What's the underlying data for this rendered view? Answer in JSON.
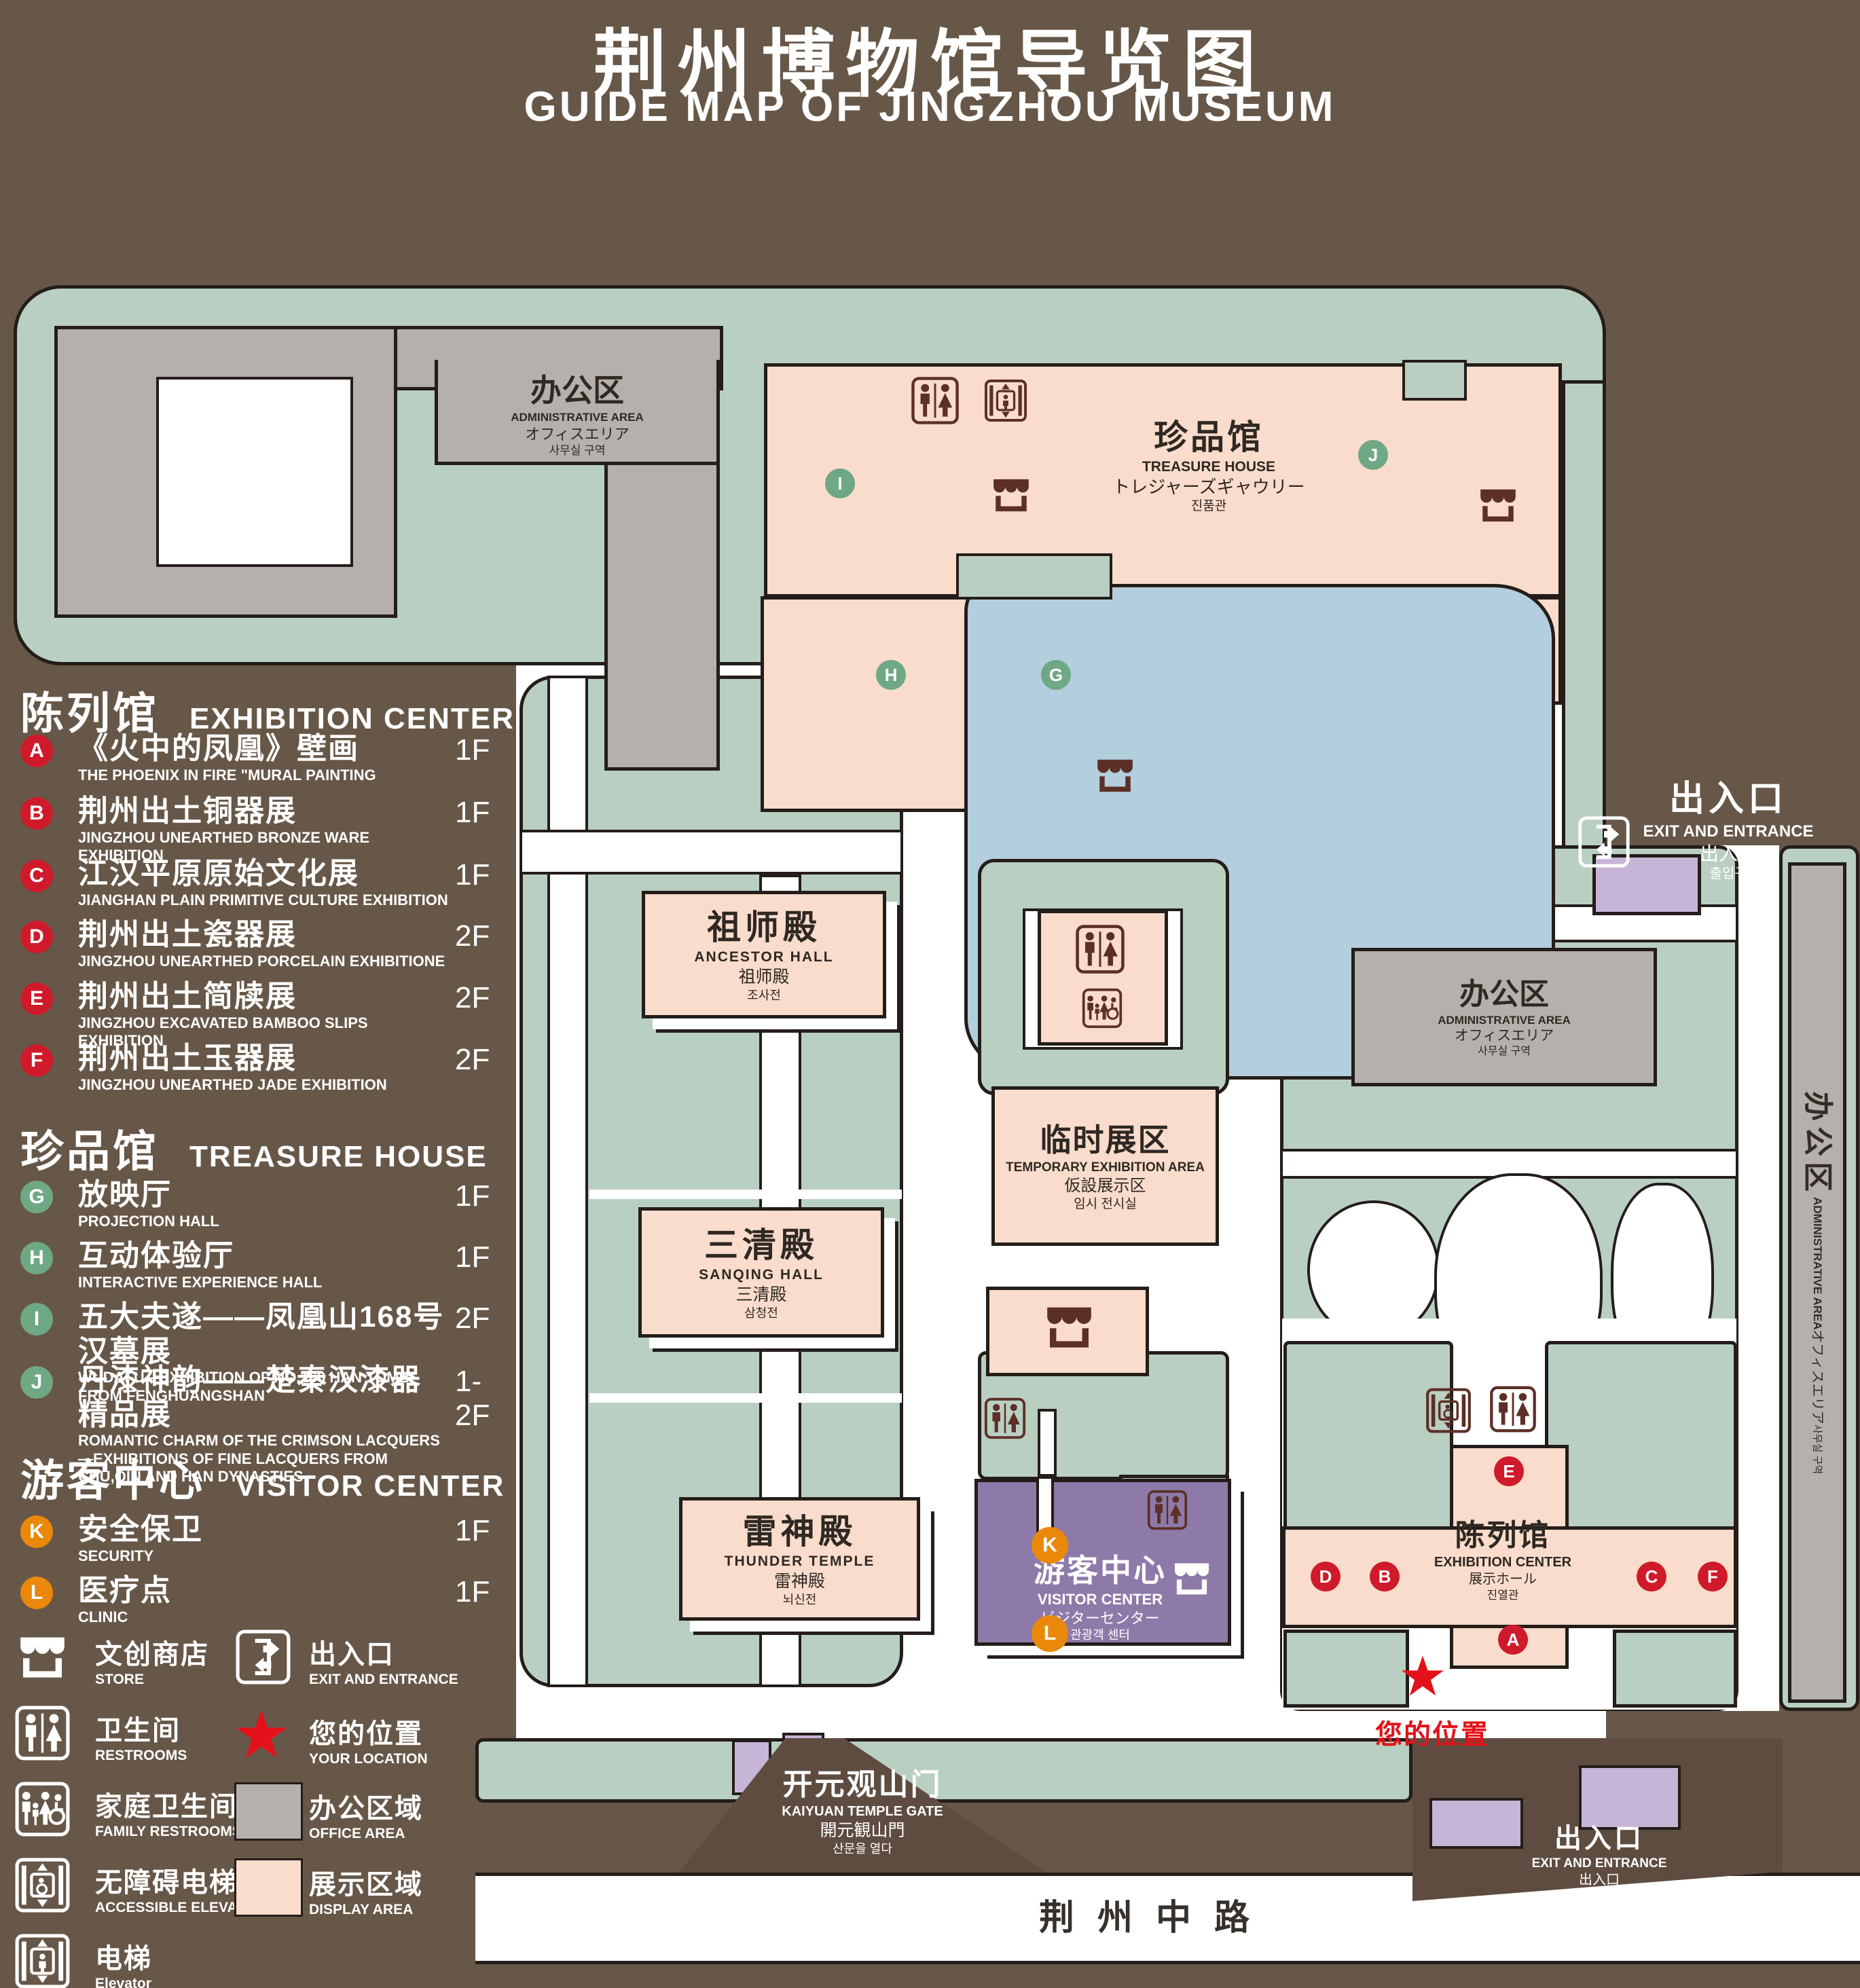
{
  "title": {
    "zh": "荆州博物馆导览图",
    "en": "GUIDE MAP OF JINGZHOU MUSEUM"
  },
  "legend": {
    "sections": [
      {
        "zh": "陈列馆",
        "en": "EXHIBITION CENTER",
        "items": [
          {
            "key": "A",
            "zh": "《火中的凤凰》壁画",
            "en": "THE PHOENIX IN FIRE \"MURAL PAINTING",
            "floor": "1F"
          },
          {
            "key": "B",
            "zh": "荆州出土铜器展",
            "en": "JINGZHOU UNEARTHED BRONZE WARE EXHIBITION",
            "floor": "1F"
          },
          {
            "key": "C",
            "zh": "江汉平原原始文化展",
            "en": "JIANGHAN PLAIN PRIMITIVE CULTURE EXHIBITION",
            "floor": "1F"
          },
          {
            "key": "D",
            "zh": "荆州出土瓷器展",
            "en": "JINGZHOU UNEARTHED PORCELAIN EXHIBITIONE",
            "floor": "2F"
          },
          {
            "key": "E",
            "zh": "荆州出土简牍展",
            "en": "JINGZHOU EXCAVATED BAMBOO SLIPS EXHIBITION",
            "floor": "2F"
          },
          {
            "key": "F",
            "zh": "荆州出土玉器展",
            "en": "JINGZHOU UNEARTHED JADE EXHIBITION",
            "floor": "2F"
          }
        ]
      },
      {
        "zh": "珍品馆",
        "en": "TREASURE HOUSE",
        "items": [
          {
            "key": "G",
            "zh": "放映厅",
            "en": "PROJECTION HALL",
            "floor": "1F"
          },
          {
            "key": "H",
            "zh": "互动体验厅",
            "en": "INTERACTIVE EXPERIENCE HALL",
            "floor": "1F"
          },
          {
            "key": "I",
            "zh": "五大夫遂——凤凰山168号汉墓展",
            "en": "WUDAFU—EXHIBITION OF NO.168 HAN TOMB FROM FENGHUANGSHAN",
            "floor": "2F"
          },
          {
            "key": "J",
            "zh": "丹漆神韵——楚秦汉漆器精品展",
            "en": "ROMANTIC CHARM OF THE CRIMSON LACQUERS—EXHIBITIONS OF FINE LACQUERS FROM CHU,QIN AND HAN DYNASTIES",
            "floor": "1-2F"
          }
        ]
      },
      {
        "zh": "游客中心",
        "en": "VISITOR CENTER",
        "items": [
          {
            "key": "K",
            "zh": "安全保卫",
            "en": "SECURITY",
            "floor": "1F"
          },
          {
            "key": "L",
            "zh": "医疗点",
            "en": "CLINIC",
            "floor": "1F"
          }
        ]
      }
    ],
    "icons": [
      {
        "icon": "store-icon",
        "zh": "文创商店",
        "en": "STORE"
      },
      {
        "icon": "restroom-icon",
        "zh": "卫生间",
        "en": "RESTROOMS"
      },
      {
        "icon": "family-restroom-icon",
        "zh": "家庭卫生间",
        "en": "FAMILY RESTROOMS"
      },
      {
        "icon": "accessible-elevator-icon",
        "zh": "无障碍电梯",
        "en": "ACCESSIBLE ELEVATOR"
      },
      {
        "icon": "elevator-icon",
        "zh": "电梯",
        "en": "Elevator"
      },
      {
        "icon": "exit-icon",
        "zh": "出入口",
        "en": "EXIT AND ENTRANCE"
      },
      {
        "icon": "location-star-icon",
        "zh": "您的位置",
        "en": "YOUR LOCATION"
      },
      {
        "icon": "office-swatch",
        "zh": "办公区域",
        "en": "OFFICE AREA"
      },
      {
        "icon": "display-swatch",
        "zh": "展示区域",
        "en": "DISPLAY AREA"
      }
    ]
  },
  "map": {
    "buildings": {
      "admin": {
        "zh": "办公区",
        "en": "ADMINISTRATIVE AREA",
        "ja": "オフィスエリア",
        "ko": "사무실 구역"
      },
      "treasure": {
        "zh": "珍品馆",
        "en": "TREASURE HOUSE",
        "ja": "トレジャーズギャウリー",
        "ko": "진품관"
      },
      "ancestor": {
        "zh": "祖师殿",
        "en": "ANCESTOR HALL",
        "ja": "祖师殿",
        "ko": "조사전"
      },
      "sanqing": {
        "zh": "三清殿",
        "en": "SANQING HALL",
        "ja": "三清殿",
        "ko": "삼청전"
      },
      "thunder": {
        "zh": "雷神殿",
        "en": "THUNDER TEMPLE",
        "ja": "雷神殿",
        "ko": "뇌신전"
      },
      "temp_exhibit": {
        "zh": "临时展区",
        "en": "TEMPORARY EXHIBITION AREA",
        "ja": "仮設展示区",
        "ko": "임시 전시실"
      },
      "exhibition": {
        "zh": "陈列馆",
        "en": "EXHIBITION CENTER",
        "ja": "展示ホール",
        "ko": "진열관"
      },
      "visitor": {
        "zh": "游客中心",
        "en": "VISITOR CENTER",
        "ja": "ビジターセンター",
        "ko": "관광객 센터"
      },
      "gate": {
        "zh": "开元观山门",
        "en": "KAIYUAN TEMPLE GATE",
        "ja": "開元観山門",
        "ko": "산문을 열다"
      },
      "exit": {
        "zh": "出入口",
        "en": "EXIT AND ENTRANCE",
        "ja": "出入口",
        "ko": "출입구"
      }
    },
    "road": {
      "zh": "荆州中路"
    }
  },
  "colors": {
    "background": "#675748",
    "outline": "#241d19",
    "green_area": "#b9cfc2",
    "display_area": "#f9dccb",
    "office_area": "#b6b0ac",
    "visitor_center": "#8d7aa9",
    "entrance_block": "#c7b5d8",
    "lake": "#b3cedd",
    "marker_red": "#cf1a2b",
    "marker_green": "#6fa884",
    "marker_orange": "#e9880b",
    "icon_brown": "#5c3026",
    "location_red": "#e3121a"
  }
}
